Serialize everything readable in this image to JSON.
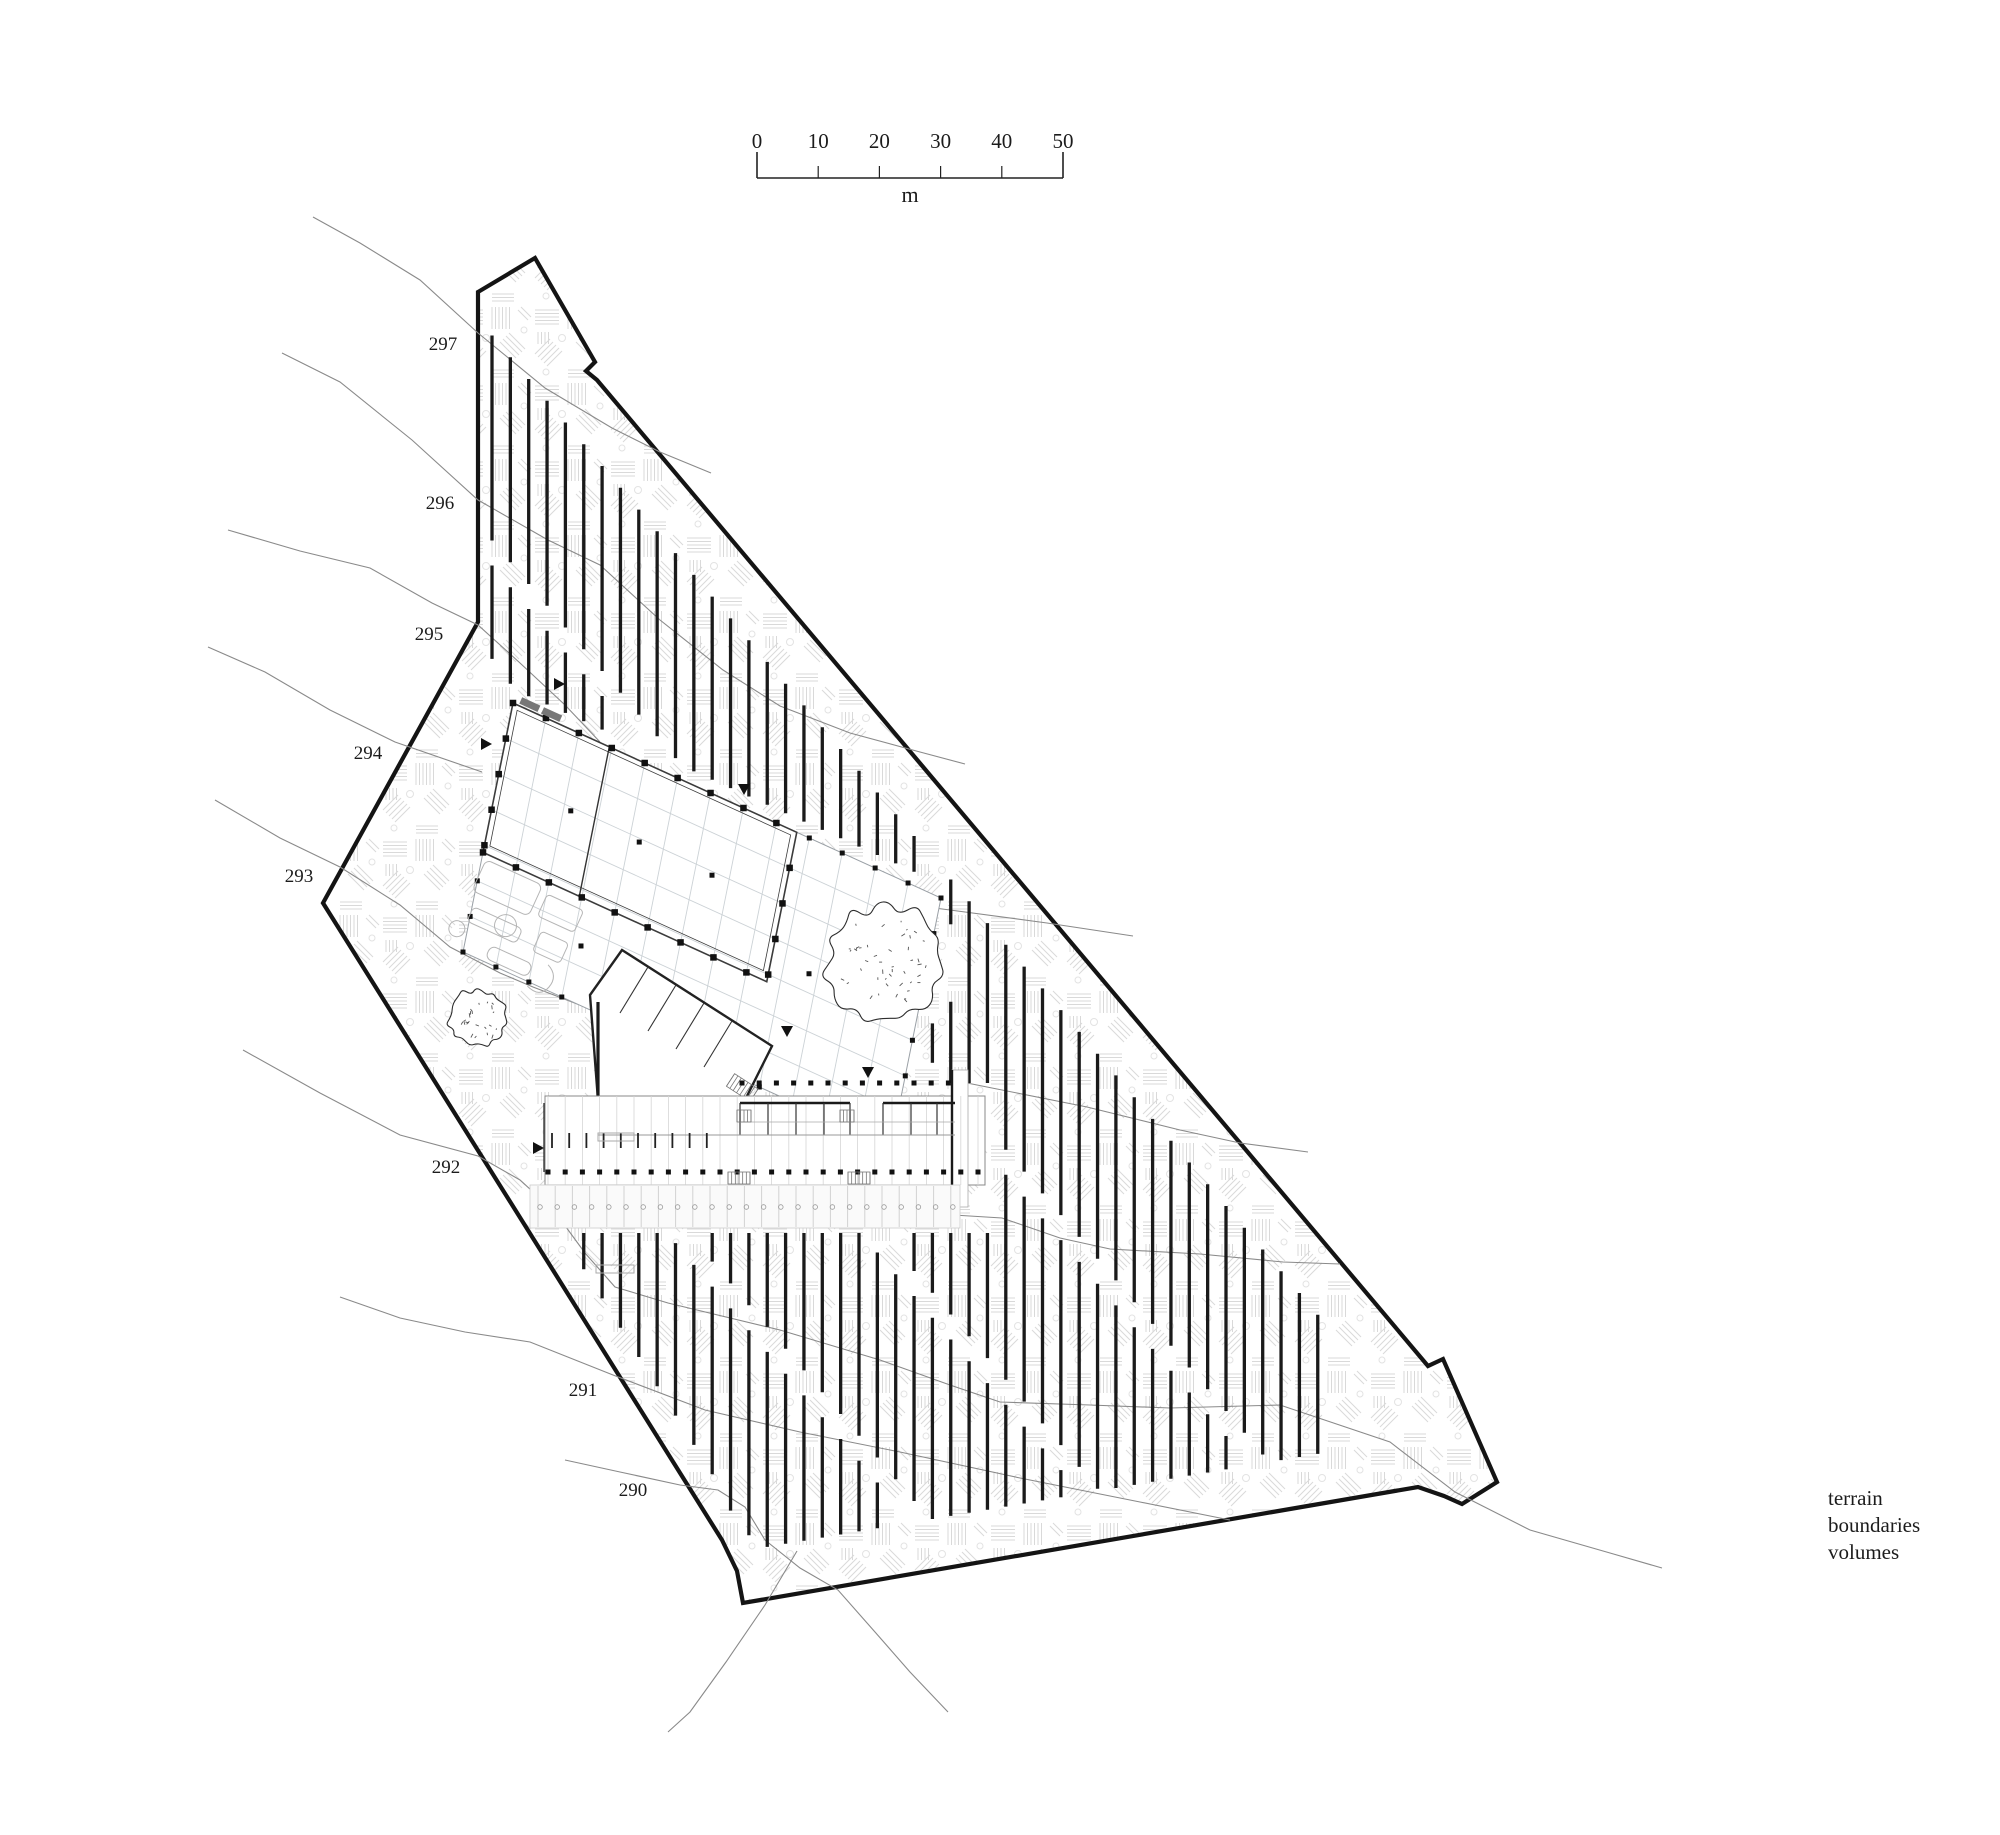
{
  "drawing": {
    "kind": "architectural-site-plan"
  },
  "scalebar": {
    "ticks": [
      "0",
      "10",
      "20",
      "30",
      "40",
      "50"
    ],
    "unit": "m"
  },
  "contour_labels": [
    {
      "label": "297"
    },
    {
      "label": "296"
    },
    {
      "label": "295"
    },
    {
      "label": "294"
    },
    {
      "label": "293"
    },
    {
      "label": "292"
    },
    {
      "label": "291"
    },
    {
      "label": "290"
    }
  ],
  "legend": {
    "items": [
      "terrain",
      "boundaries",
      "volumes"
    ]
  },
  "colors": {
    "boundary": "#141414",
    "hatch": "#1a1a1a",
    "contour": "#8a8a8a",
    "texture": "#d9d9d9",
    "grid": "#ccd2d6"
  }
}
